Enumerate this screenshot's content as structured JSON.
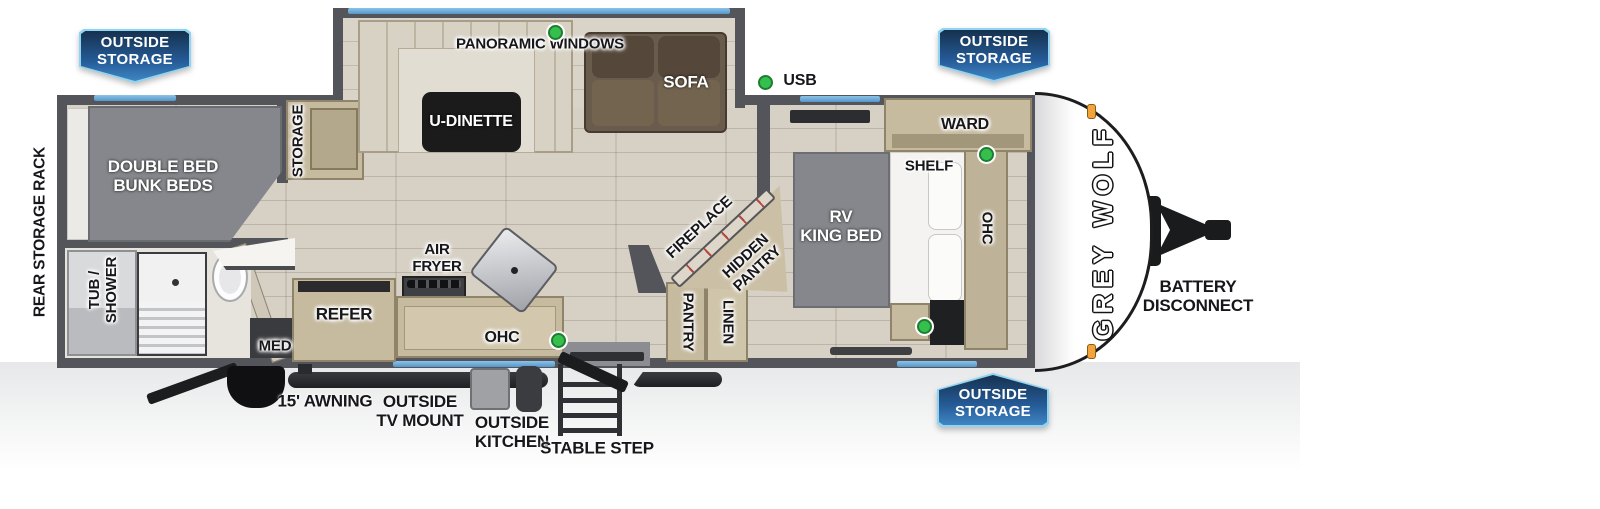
{
  "brand": {
    "logo_text": "GREY WOLF"
  },
  "badges": {
    "outside_storage": {
      "line1": "OUTSIDE",
      "line2": "STORAGE"
    }
  },
  "exterior": {
    "rear_storage_rack": "REAR STORAGE RACK",
    "awning": "15' AWNING",
    "tv_mount": {
      "line1": "OUTSIDE",
      "line2": "TV MOUNT"
    },
    "outside_kitchen": {
      "line1": "OUTSIDE",
      "line2": "KITCHEN"
    },
    "stable_step": "STABLE STEP",
    "battery_disconnect": {
      "line1": "BATTERY",
      "line2": "DISCONNECT"
    },
    "usb": "USB"
  },
  "interior": {
    "panoramic_windows": "PANORAMIC WINDOWS",
    "u_dinette": "U-DINETTE",
    "sofa": "SOFA",
    "storage": "STORAGE",
    "bunk": {
      "line1": "DOUBLE BED",
      "line2": "BUNK BEDS"
    },
    "tub_shower": {
      "line1": "TUB /",
      "line2": "SHOWER"
    },
    "med": "MED",
    "refer": "REFER",
    "air_fryer": {
      "line1": "AIR",
      "line2": "FRYER"
    },
    "ohc_kitchen": "OHC",
    "pantry": "PANTRY",
    "linen": "LINEN",
    "fireplace": "FIREPLACE",
    "hidden_pantry": {
      "line1": "HIDDEN",
      "line2": "PANTRY"
    },
    "king_bed": {
      "line1": "RV",
      "line2": "KING BED"
    },
    "ward": "WARD",
    "shelf": "SHELF",
    "ohc_bedroom": "OHC"
  },
  "colors": {
    "wall": "#54555a",
    "floor": "#d7d1c5",
    "window_blue": "#5596c9",
    "usb_green": "#35c04e",
    "badge_dark": "#16314e",
    "badge_light": "#3f86c4",
    "badge_border": "#8fd4f0",
    "cabinet_tan": "#c6ba9f",
    "bed_gray": "#85878c",
    "sofa_brown": "#6a5c4d",
    "marker_orange": "#f2a33c"
  }
}
